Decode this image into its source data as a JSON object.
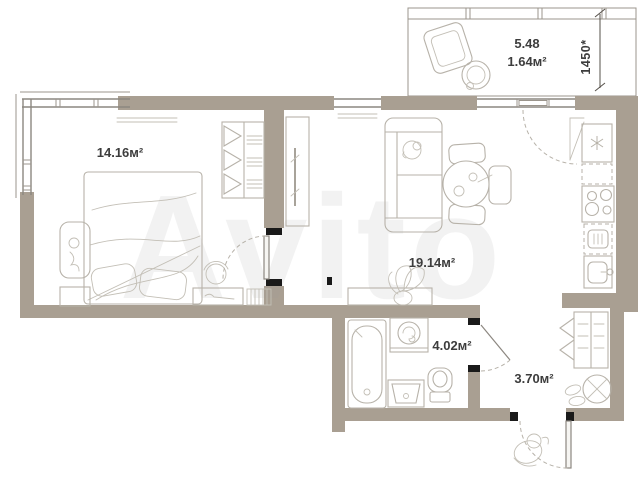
{
  "floorplan": {
    "watermark": "Avito",
    "rooms": [
      {
        "id": "bedroom",
        "area_label": "14.16м²"
      },
      {
        "id": "living_room",
        "area_label": "19.14м²"
      },
      {
        "id": "bathroom",
        "area_label": "4.02м²"
      },
      {
        "id": "hallway",
        "area_label": "3.70м²"
      },
      {
        "id": "balcony",
        "area_full_label": "5.48",
        "area_label": "1.64м²"
      }
    ],
    "dimension_labels": {
      "balcony_width": "1450*"
    },
    "colors": {
      "walls": "#a99f92",
      "window_lines": "#8c8780",
      "furniture_lines": "#b7b2a9",
      "label_text": "#3d3d3d",
      "door_jambs": "#1a1a1a",
      "watermark": "#9b9b9b",
      "background": "#ffffff"
    }
  }
}
